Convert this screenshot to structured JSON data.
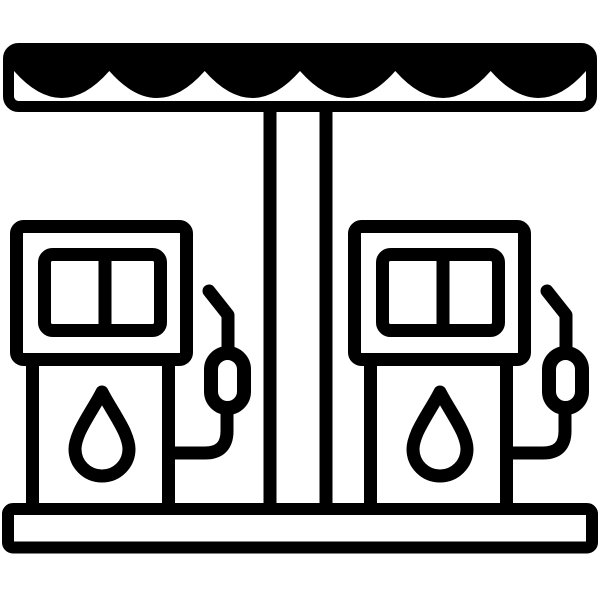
{
  "page": {
    "background_color": "#ffffff",
    "title": "Gas station icon"
  },
  "icon": {
    "name": "gas-station",
    "title": "Gas station",
    "color": "#000000",
    "style": "black outline glyph on white background",
    "elements": {
      "canopy": {
        "label": "rectangular canopy roof with scalloped awning",
        "scallop_count": 6
      },
      "pillar": {
        "label": "central support pillar"
      },
      "base": {
        "label": "ground platform bar"
      },
      "pumps": [
        {
          "id": "left-pump",
          "label": "fuel pump",
          "display_panes": 2,
          "symbol": "fuel-drop",
          "accessory": "nozzle with hose on right side"
        },
        {
          "id": "right-pump",
          "label": "fuel pump",
          "display_panes": 2,
          "symbol": "fuel-drop",
          "accessory": "nozzle with hose on right side"
        }
      ]
    }
  }
}
